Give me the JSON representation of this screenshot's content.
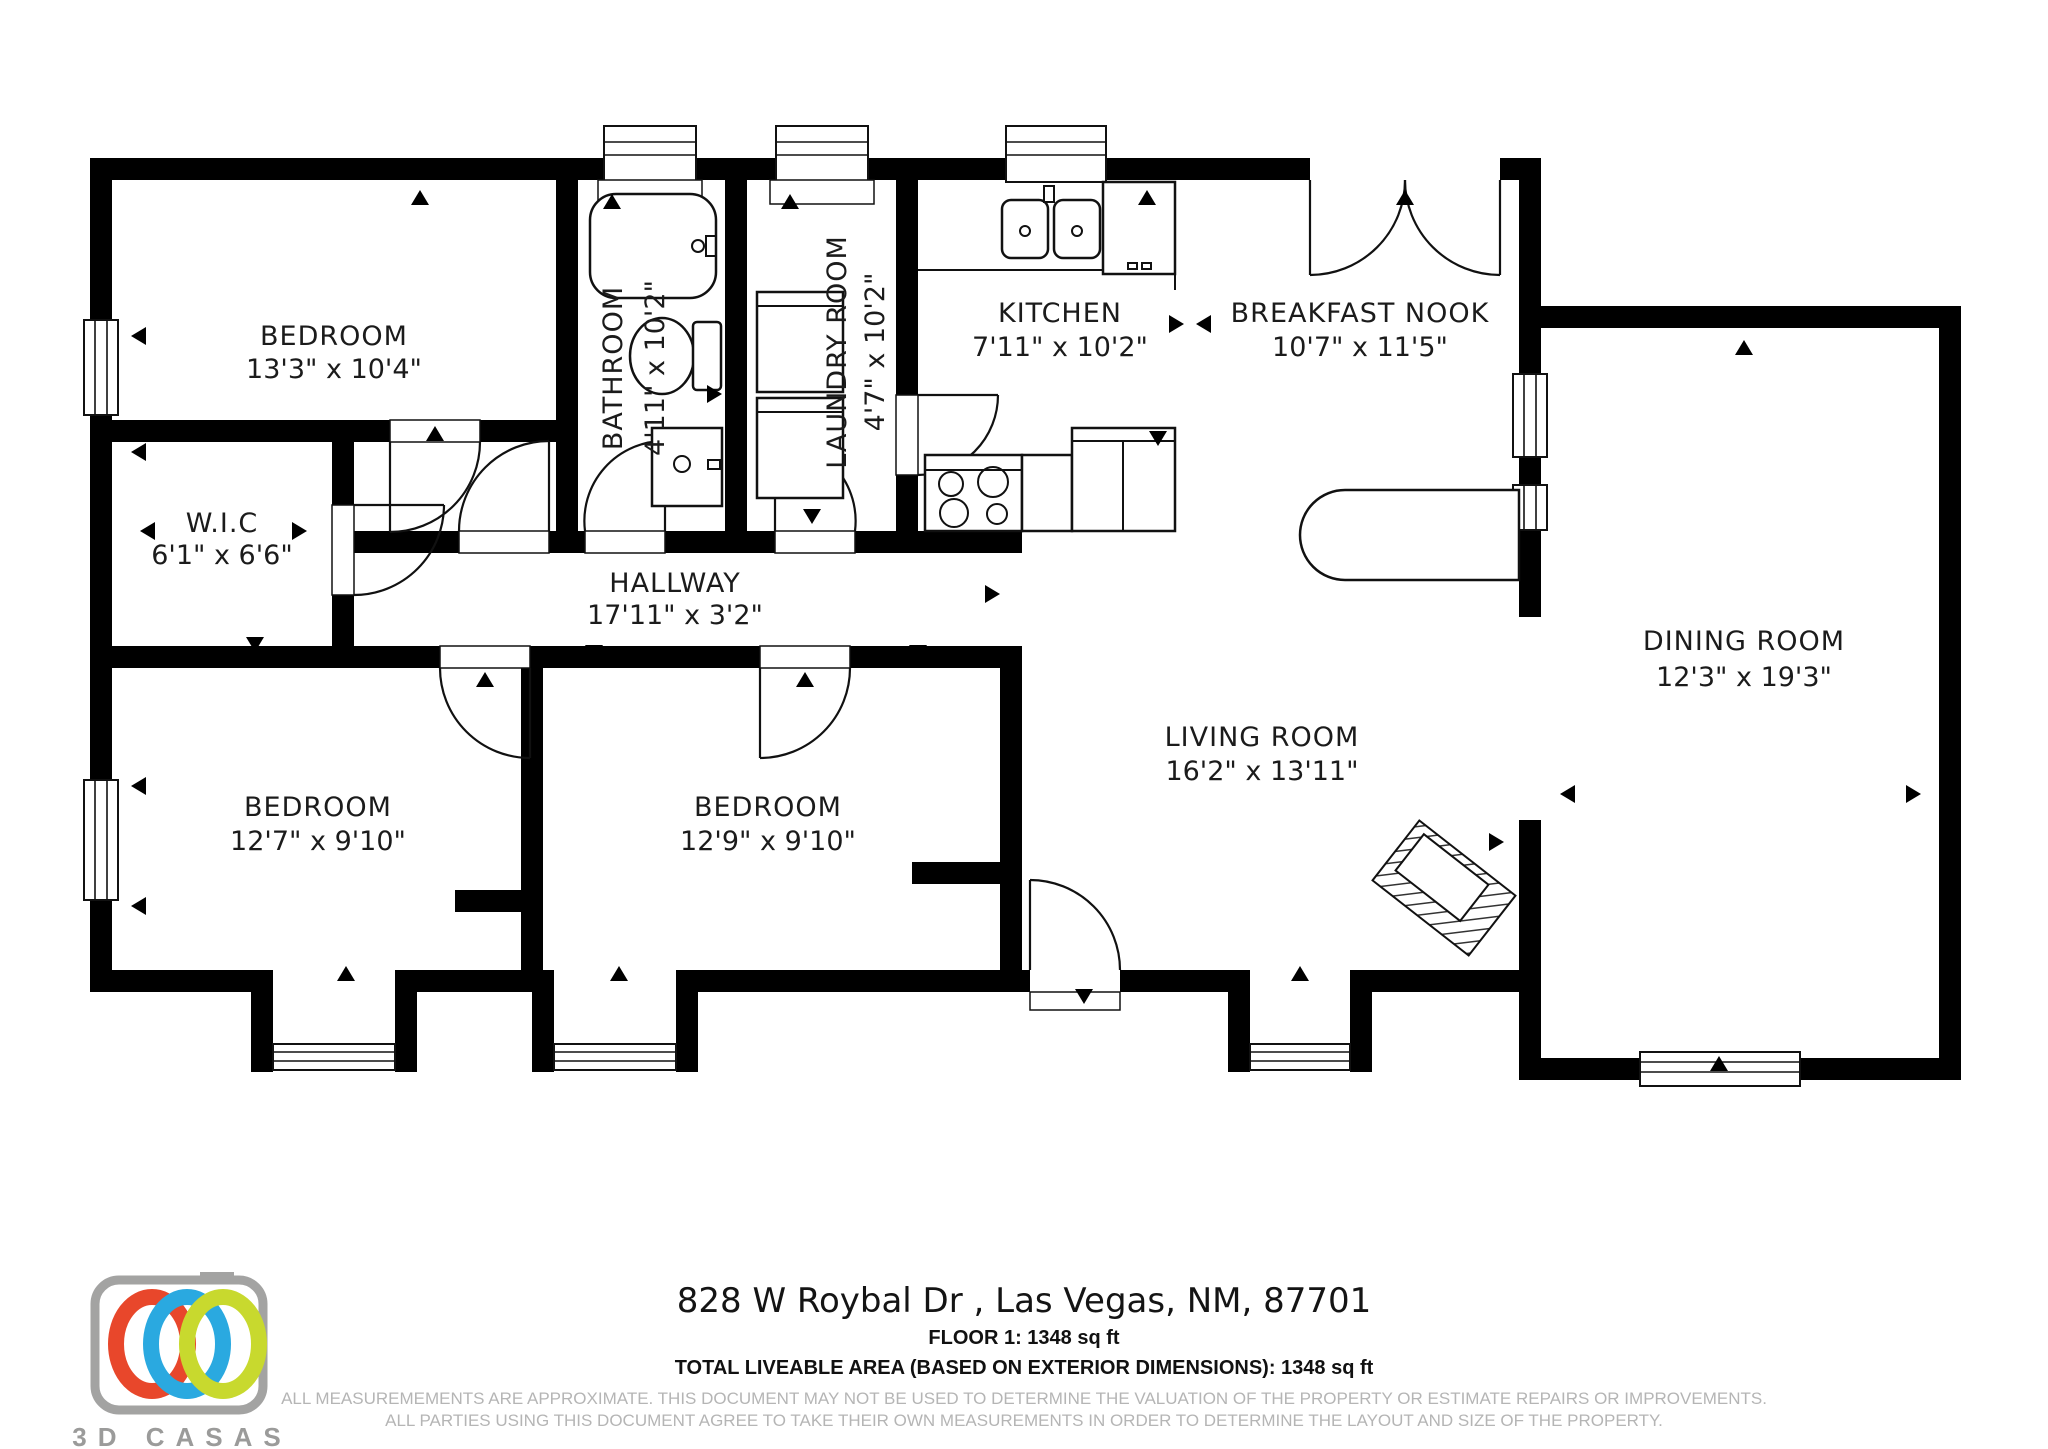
{
  "floorplan": {
    "rooms": [
      {
        "name": "BEDROOM",
        "dims": "13'3\" x 10'4\""
      },
      {
        "name": "BATHROOM",
        "dims": "4'11\" x 10'2\""
      },
      {
        "name": "LAUNDRY ROOM",
        "dims": "4'7\" x 10'2\""
      },
      {
        "name": "KITCHEN",
        "dims": "7'11\" x 10'2\""
      },
      {
        "name": "BREAKFAST NOOK",
        "dims": "10'7\" x 11'5\""
      },
      {
        "name": "W.I.C",
        "dims": "6'1\" x 6'6\""
      },
      {
        "name": "HALLWAY",
        "dims": "17'11\" x 3'2\""
      },
      {
        "name": "DINING ROOM",
        "dims": "12'3\" x 19'3\""
      },
      {
        "name": "BEDROOM",
        "dims": "12'7\" x 9'10\""
      },
      {
        "name": "BEDROOM",
        "dims": "12'9\" x 9'10\""
      },
      {
        "name": "LIVING ROOM",
        "dims": "16'2\" x 13'11\""
      }
    ]
  },
  "footer": {
    "address": "828 W Roybal Dr , Las Vegas, NM, 87701",
    "floor_line": "FLOOR 1: 1348 sq ft",
    "total_line": "TOTAL LIVEABLE AREA (BASED ON EXTERIOR DIMENSIONS): 1348 sq ft",
    "disclaimer_line1": "ALL MEASUREMEMENTS ARE APPROXIMATE. THIS DOCUMENT MAY NOT BE USED TO DETERMINE THE VALUATION OF THE PROPERTY OR ESTIMATE REPAIRS OR IMPROVEMENTS.",
    "disclaimer_line2": "ALL PARTIES USING THIS DOCUMENT AGREE TO TAKE THEIR OWN MEASUREMENTS IN ORDER TO DETERMINE THE LAYOUT AND SIZE OF THE PROPERTY."
  },
  "logo": {
    "brand": "3D CASAS",
    "colors": {
      "red": "#e8472b",
      "blue": "#2aa9e0",
      "green": "#c8d92e",
      "grey": "#a3a3a2"
    }
  }
}
